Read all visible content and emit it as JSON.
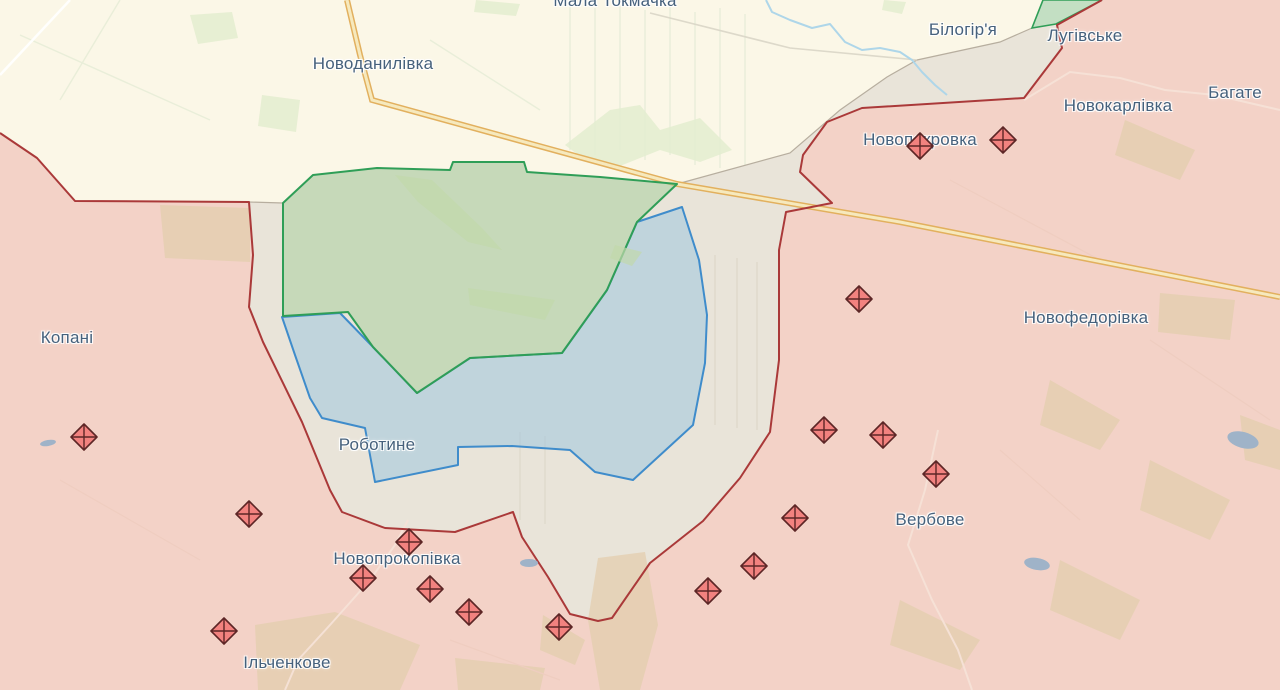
{
  "map": {
    "description": "frontline-map-viewport",
    "places": [
      {
        "name": "Мала Токмачка",
        "x": 615,
        "y": 1
      },
      {
        "name": "Новоданилівка",
        "x": 373,
        "y": 64
      },
      {
        "name": "Білогір'я",
        "x": 963,
        "y": 30
      },
      {
        "name": "Лугівське",
        "x": 1085,
        "y": 36
      },
      {
        "name": "Новокарлівка",
        "x": 1118,
        "y": 106
      },
      {
        "name": "Багате",
        "x": 1235,
        "y": 93
      },
      {
        "name": "Новопокровка",
        "x": 920,
        "y": 140
      },
      {
        "name": "Новофедорівка",
        "x": 1086,
        "y": 318
      },
      {
        "name": "Копані",
        "x": 67,
        "y": 338
      },
      {
        "name": "Роботине",
        "x": 377,
        "y": 445
      },
      {
        "name": "Вербове",
        "x": 930,
        "y": 520
      },
      {
        "name": "Новопрокопівка",
        "x": 397,
        "y": 559
      },
      {
        "name": "Ільченкове",
        "x": 287,
        "y": 663
      }
    ],
    "marker_icon": "fortification-diamond-icon",
    "fortification_markers": [
      {
        "x": 920,
        "y": 146
      },
      {
        "x": 1003,
        "y": 140
      },
      {
        "x": 859,
        "y": 299
      },
      {
        "x": 84,
        "y": 437
      },
      {
        "x": 824,
        "y": 430
      },
      {
        "x": 883,
        "y": 435
      },
      {
        "x": 936,
        "y": 474
      },
      {
        "x": 795,
        "y": 518
      },
      {
        "x": 249,
        "y": 514
      },
      {
        "x": 409,
        "y": 542
      },
      {
        "x": 363,
        "y": 578
      },
      {
        "x": 430,
        "y": 589
      },
      {
        "x": 469,
        "y": 612
      },
      {
        "x": 224,
        "y": 631
      },
      {
        "x": 559,
        "y": 627
      },
      {
        "x": 708,
        "y": 591
      },
      {
        "x": 754,
        "y": 566
      }
    ]
  },
  "theme": {
    "free": "#fbf7e7",
    "occupied": "#f3d2c7",
    "frontline": "#aa3939",
    "buffer": "#e9e4d9",
    "bufferBorder": "#b7ae9f",
    "liberatedFill": "#a9cf9f",
    "liberatedBorder": "#2f9e57",
    "advanceFill": "#9fc6de",
    "advanceBorder": "#3f8ccb",
    "wedgeFill": "#b5d8ba",
    "highwayCasing": "#e2b05e",
    "highwayCore": "#f6e9bd",
    "river": "#aed6e9",
    "roadWhite": "#ffffff",
    "roadGray": "#d9d5c6",
    "roadPink": "#f6e2d7",
    "labelColor": "#46617c",
    "markerFill": "#f2827f",
    "markerStroke": "#5d2626",
    "pond": "#9fb3c8",
    "forestTan": "#e3cdad",
    "forestGreen": "#c2d8ab",
    "fieldCream": "#e2ecce"
  }
}
